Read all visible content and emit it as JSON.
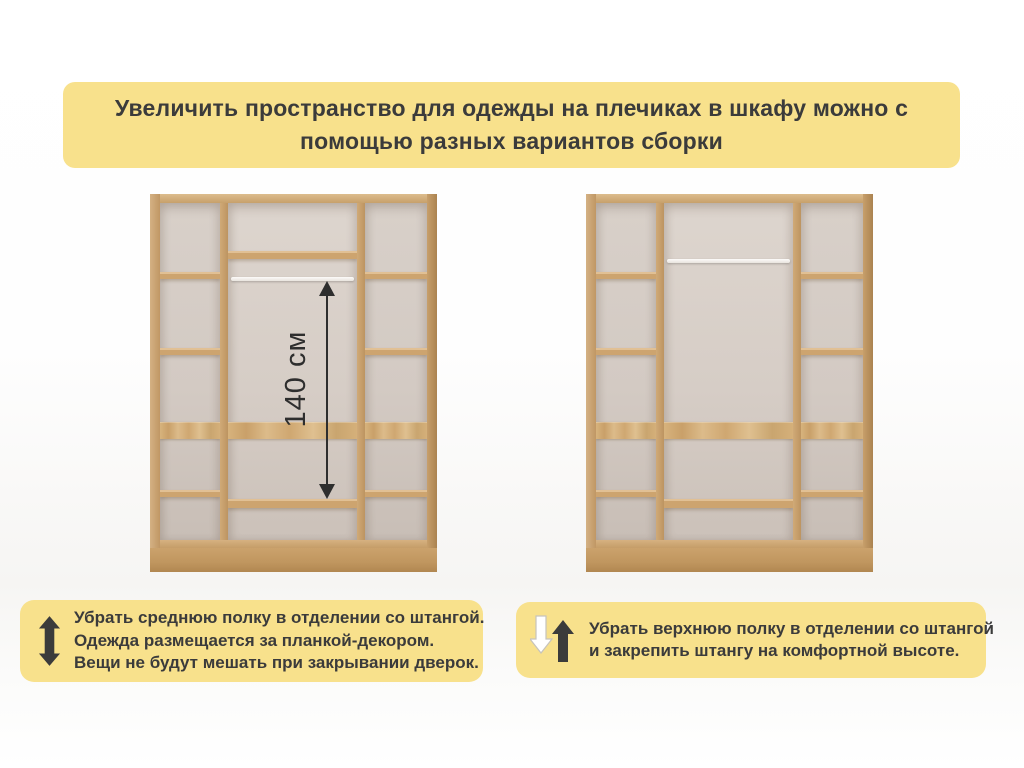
{
  "title_banner": {
    "lines": [
      "Увеличить пространство для одежды на плечиках в шкафу можно с",
      "помощью разных вариантов сборки"
    ],
    "bg_color": "#f8e18c",
    "text_color": "#3b3b3b"
  },
  "wardrobes": {
    "left": {
      "variant": "средняя полка убрана, штанга за планкой-декором",
      "dimension_label": "140 см"
    },
    "right": {
      "variant": "верхняя полка убрана, штанга закреплена выше"
    }
  },
  "notes": {
    "left": {
      "icon": "resize-vertical-arrow-icon",
      "lines": [
        "Убрать среднюю полку в отделении со штангой.",
        "Одежда размещается за планкой-декором.",
        "Вещи не будут мешать при закрывании дверок."
      ],
      "bg_color": "#f8e18c"
    },
    "right": {
      "icon": "down-up-arrows-icon",
      "lines": [
        "Убрать верхнюю полку в отделении со штангой",
        "и закрепить штангу на комфортной высоте."
      ],
      "bg_color": "#f8e18c"
    }
  },
  "colors": {
    "wood": "#cba572",
    "wood_dark": "#b08954",
    "interior_back": "#d5cdc6",
    "rod": "#f6f3ee",
    "accent_yellow": "#f8e18c",
    "text_dark": "#3b3b3b"
  }
}
